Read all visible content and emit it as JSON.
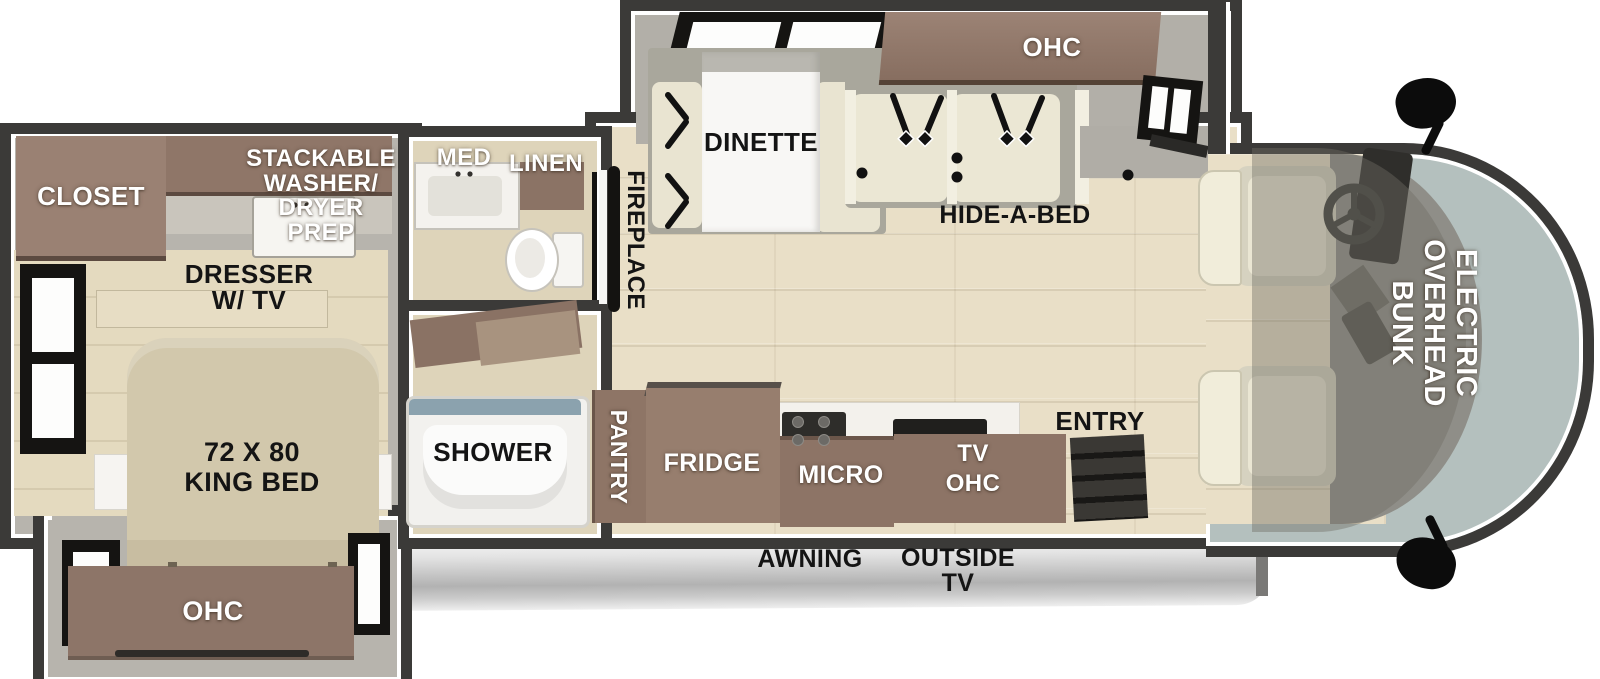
{
  "plan": {
    "bedroom": {
      "closet_label": "CLOSET",
      "washer_prep_lines": [
        "STACKABLE",
        "WASHER/",
        "DRYER",
        "PREP"
      ],
      "dresser_lines": [
        "DRESSER",
        "W/ TV"
      ],
      "king_bed_lines": [
        "72 X 80",
        "KING BED"
      ],
      "ohc_label": "OHC"
    },
    "bathroom": {
      "med_label": "MED",
      "linen_label": "LINEN",
      "shower_label": "SHOWER"
    },
    "living": {
      "fireplace_label": "FIREPLACE",
      "dinette_label": "DINETTE",
      "ohc_label": "OHC",
      "hide_a_bed_label": "HIDE-A-BED"
    },
    "kitchen": {
      "pantry_label": "PANTRY",
      "fridge_label": "FRIDGE",
      "micro_label": "MICRO",
      "tv_ohc_lines": [
        "TV",
        "OHC"
      ],
      "entry_label": "ENTRY"
    },
    "cab": {
      "bunk_lines": [
        "ELECTRIC",
        "OVERHEAD",
        "BUNK"
      ]
    },
    "exterior": {
      "awning_label": "AWNING",
      "outside_tv_lines": [
        "OUTSIDE",
        "TV"
      ]
    },
    "colors": {
      "wall": "#3b3a38",
      "trim": "#ffffff",
      "floor_wood": "#e9dfc7",
      "bedroom_floor": "#e4dabf",
      "interior_wall": "#b7b4ad",
      "cabinet_brown": "#8d7466",
      "closet_brown": "#9a8173",
      "bed_tan": "#d2c8ac",
      "cushion_cream": "#ebe7d4",
      "windshield_glass": "#b4c0be",
      "cockpit_gray": "#8f8e88",
      "awning_gray": "#c9c9c9",
      "label_black": "#141414",
      "label_white": "#ffffff"
    }
  }
}
